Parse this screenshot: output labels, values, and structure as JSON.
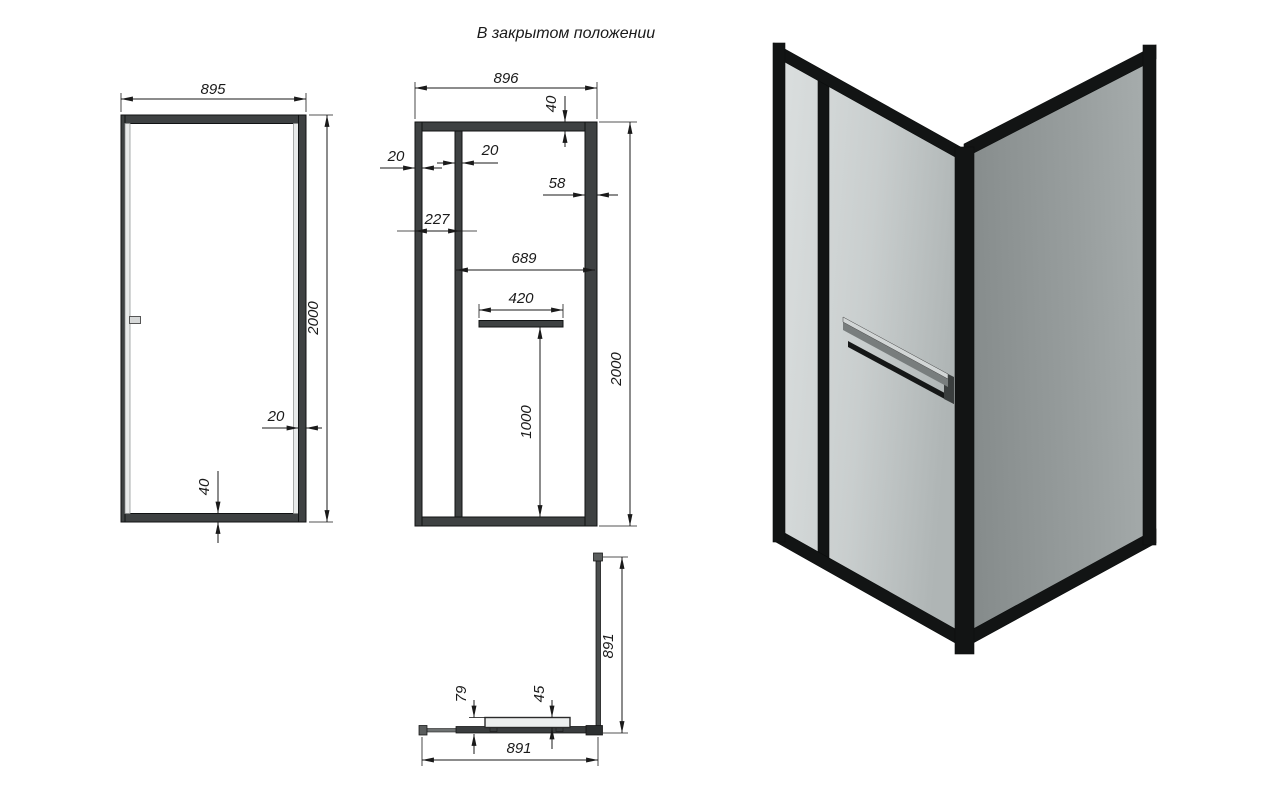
{
  "title": "В закрытом положении",
  "views": {
    "side": {
      "name": "side view",
      "dims": {
        "width": "895",
        "height": "2000",
        "profile": "20",
        "bottom_profile": "40"
      }
    },
    "front": {
      "name": "front view",
      "dims": {
        "width": "896",
        "top_profile": "40",
        "wall_profile": "20",
        "stile": "20",
        "right_profile": "58",
        "fixed_panel": "227",
        "door_opening": "689",
        "handle_width": "420",
        "handle_height": "1000",
        "height": "2000"
      }
    },
    "plan": {
      "name": "top view",
      "dims": {
        "depth": "891",
        "width": "891",
        "handle_offset": "79",
        "handle_profile": "45"
      }
    }
  },
  "colors": {
    "line": "#1a1a1a",
    "frame_2d": "#3e4142",
    "frame_3d": "#121414",
    "glass_light": "#c9cece",
    "glass_dark": "#979d9d",
    "background": "#ffffff"
  }
}
